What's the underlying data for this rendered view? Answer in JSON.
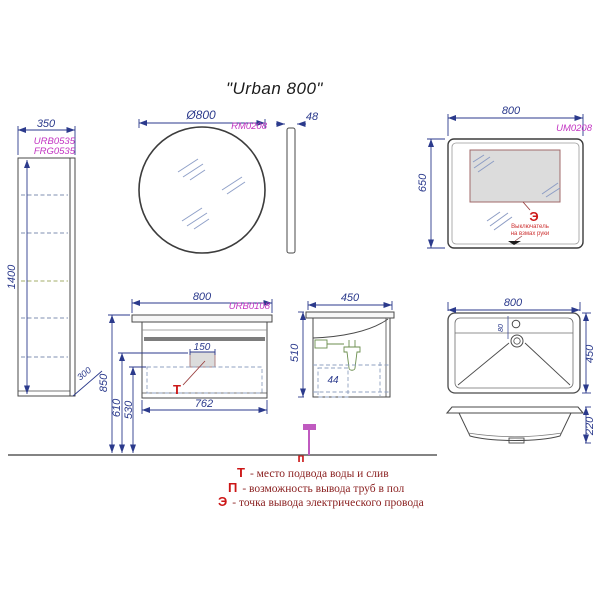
{
  "title": "\"Urban 800\"",
  "colors": {
    "line": "#4a4a4a",
    "dimension": "#2b3a8c",
    "code_magenta": "#c233c2",
    "marker_red": "#cc1a1a",
    "legend_text": "#8b2121",
    "hatch_blue": "#8fa0c8",
    "siphon_green": "#6b8e4e",
    "floor_marker_magenta": "#c05ac0",
    "lit_area_fill": "#dcdcdc"
  },
  "tall_cabinet": {
    "code_line1": "URB0535",
    "code_line2": "FRG0535",
    "dim_width": "350",
    "dim_height": "1400",
    "dim_bottom_gap": "300"
  },
  "round_mirror": {
    "dim_diameter": "Ø800",
    "code": "RM0208",
    "dim_thickness": "48"
  },
  "led_mirror": {
    "dim_width": "800",
    "code": "UM0208",
    "dim_height": "650",
    "marker": "Э",
    "note_line1": "Выключатель",
    "note_line2": "на взмах руки"
  },
  "vanity": {
    "dim_width": "800",
    "code": "URB0108",
    "dim_siphon_box": "150",
    "dim_inner_width": "762",
    "dim_height_top": "850",
    "dim_height_mid": "610",
    "dim_height_low": "530",
    "marker": "Т"
  },
  "vanity_side": {
    "dim_depth": "450",
    "dim_height": "510",
    "dim_offset": "44"
  },
  "sink": {
    "dim_width": "800",
    "dim_depth": "450",
    "dim_height": "220",
    "dim_faucet_offset": "80"
  },
  "floor_marker": "п",
  "legend": [
    {
      "key": "Т",
      "text": "- место подвода воды и слив"
    },
    {
      "key": "П",
      "text": "- возможность вывода труб в пол"
    },
    {
      "key": "Э",
      "text": "- точка вывода электрического провода"
    }
  ]
}
